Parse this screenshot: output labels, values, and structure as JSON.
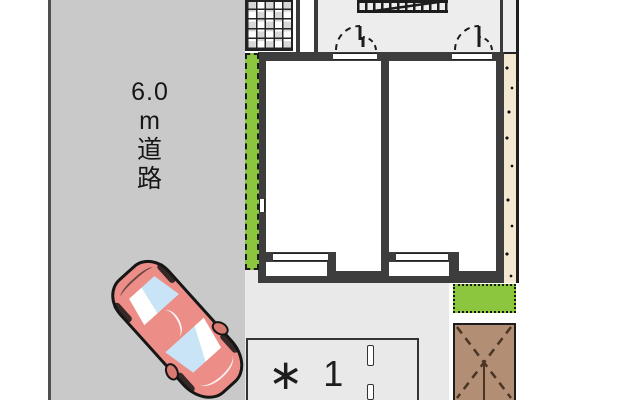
{
  "road": {
    "label": "6.0 m 道路",
    "label_lines": [
      "6.0",
      "m",
      "道",
      "路"
    ]
  },
  "parking": {
    "marker": "∗",
    "space_number": "1"
  },
  "colors": {
    "road_gray": "#c9c9c9",
    "site_gray": "#e9e9e9",
    "corridor_gray": "#ededed",
    "wall_dark": "#3d3d3d",
    "hedge_green": "#8cc63f",
    "planting_bed_green": "#8cc63f",
    "gravel_beige": "#f5e8d2",
    "deck_brown": "#b18e74",
    "deck_dash_brown": "#4a3524",
    "car_pink": "#ec8e87",
    "car_window_blue": "#c8e4f6",
    "tile_light": "#ffffff",
    "tile_dark": "#d7d7d7"
  }
}
